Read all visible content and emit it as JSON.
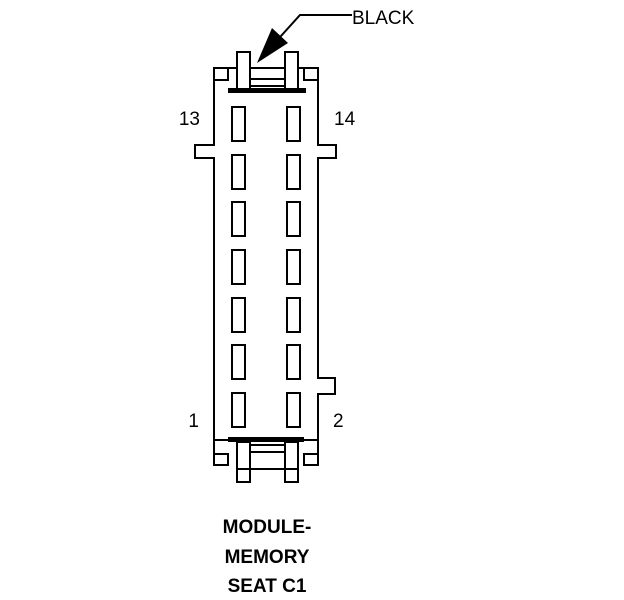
{
  "diagram": {
    "type": "connector-pinout-diagram",
    "wire_label": "BLACK",
    "pin_labels": {
      "top_left": "13",
      "top_right": "14",
      "bottom_left": "1",
      "bottom_right": "2"
    },
    "caption_lines": [
      "MODULE-",
      "MEMORY",
      "SEAT C1"
    ],
    "pin_slots": {
      "rows": 7,
      "columns": 2,
      "total": 14
    },
    "colors": {
      "line": "#000000",
      "background": "#ffffff"
    }
  }
}
